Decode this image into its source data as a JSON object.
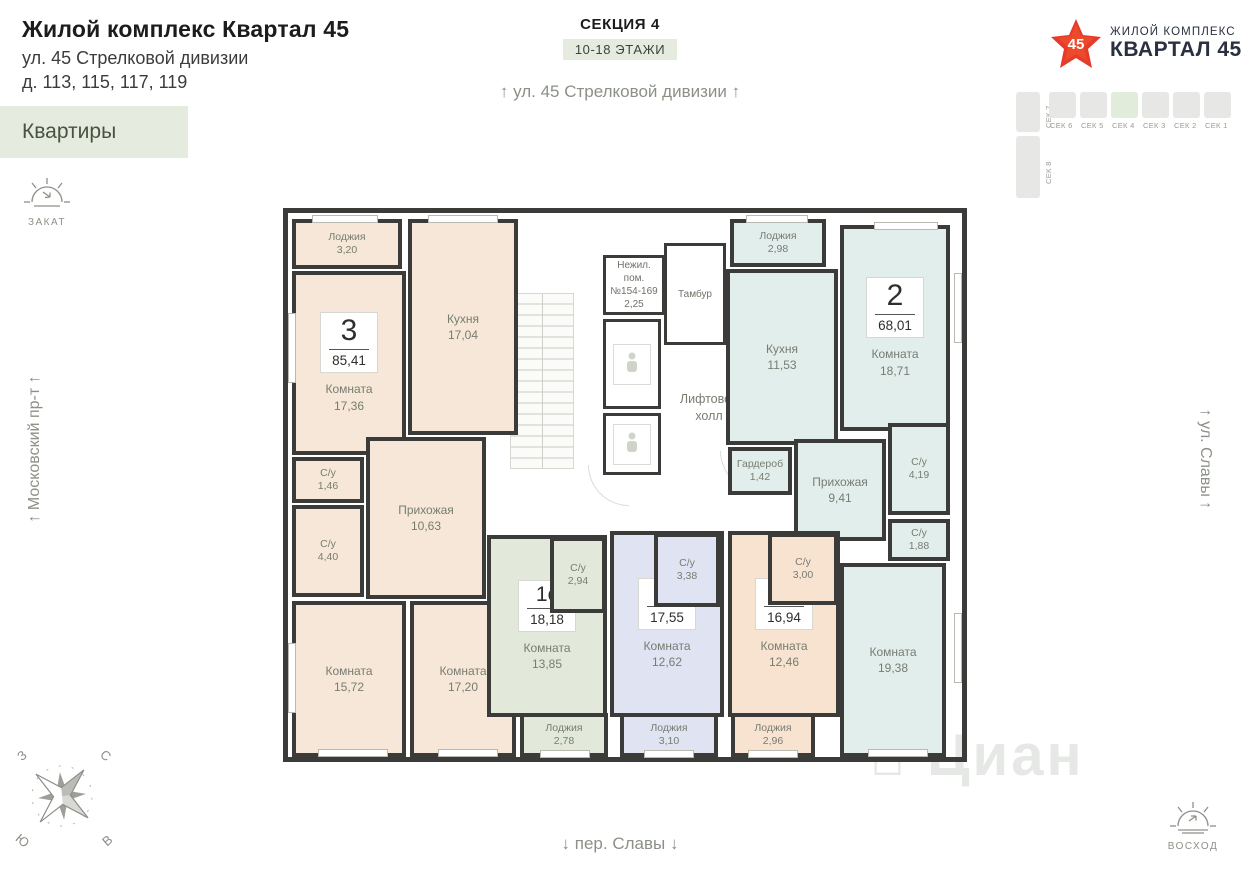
{
  "header": {
    "title": "Жилой комплекс Квартал 45",
    "address1": "ул. 45 Стрелковой дивизии",
    "address2": "д. 113, 115, 117, 119",
    "apartments_button": "Квартиры"
  },
  "section_info": {
    "section": "СЕКЦИЯ 4",
    "floors": "10-18 ЭТАЖИ"
  },
  "logo": {
    "number": "45",
    "line1": "ЖИЛОЙ КОМПЛЕКС",
    "line2": "КВАРТАЛ 45"
  },
  "section_map": {
    "sections": [
      "СЕК 6",
      "СЕК 5",
      "СЕК 4",
      "СЕК 3",
      "СЕК 2",
      "СЕК 1"
    ],
    "corner": "СЕК 7",
    "left": "СЕК 8"
  },
  "streets": {
    "top": "↑ ул. 45 Стрелковой дивизии ↑",
    "bottom": "↓ пер. Славы ↓",
    "left": "↑ Московский пр-т ↑",
    "right": "↑ ул. Славы ↑"
  },
  "sun": {
    "sunset": "ЗАКАТ",
    "sunrise": "ВОСХОД"
  },
  "compass": {
    "nw": "З",
    "ne": "С",
    "sw": "Ю",
    "se": "В"
  },
  "watermark": "Циан",
  "plan": {
    "common": {
      "nonres1": "Нежил.",
      "nonres2": "пом.",
      "nonres3": "№154-169",
      "nonres_area": "2,25",
      "tambur": "Тамбур",
      "lift1": "Лифтовой",
      "lift2": "холл"
    },
    "apt3": {
      "type": "3",
      "area": "85,41",
      "lodzhia_n": "Лоджия",
      "lodzhia_a": "3,20",
      "kitchen_n": "Кухня",
      "kitchen_a": "17,04",
      "room1_n": "Комната",
      "room1_a": "17,36",
      "su1_n": "С/у",
      "su1_a": "1,46",
      "su2_n": "С/у",
      "su2_a": "4,40",
      "hall_n": "Прихожая",
      "hall_a": "10,63",
      "room2_n": "Комната",
      "room2_a": "15,72",
      "room3_n": "Комната",
      "room3_a": "17,20"
    },
    "apt2": {
      "type": "2",
      "area": "68,01",
      "lodzhia_n": "Лоджия",
      "lodzhia_a": "2,98",
      "kitchen_n": "Кухня",
      "kitchen_a": "11,53",
      "room1_n": "Комната",
      "room1_a": "18,71",
      "garderob_n": "Гардероб",
      "garderob_a": "1,42",
      "hall_n": "Прихожая",
      "hall_a": "9,41",
      "su1_n": "С/у",
      "su1_a": "4,19",
      "su2_n": "С/у",
      "su2_a": "1,88",
      "room2_n": "Комната",
      "room2_a": "19,38"
    },
    "st1": {
      "type": "1с",
      "area": "18,18",
      "su_n": "С/у",
      "su_a": "2,94",
      "room_n": "Комната",
      "room_a": "13,85",
      "lodzhia_n": "Лоджия",
      "lodzhia_a": "2,78"
    },
    "st2": {
      "type": "1с",
      "area": "17,55",
      "su_n": "С/у",
      "su_a": "3,38",
      "room_n": "Комната",
      "room_a": "12,62",
      "lodzhia_n": "Лоджия",
      "lodzhia_a": "3,10"
    },
    "st3": {
      "type": "1с",
      "area": "16,94",
      "su_n": "С/у",
      "su_a": "3,00",
      "room_n": "Комната",
      "room_a": "12,46",
      "lodzhia_n": "Лоджия",
      "lodzhia_a": "2,96"
    }
  }
}
